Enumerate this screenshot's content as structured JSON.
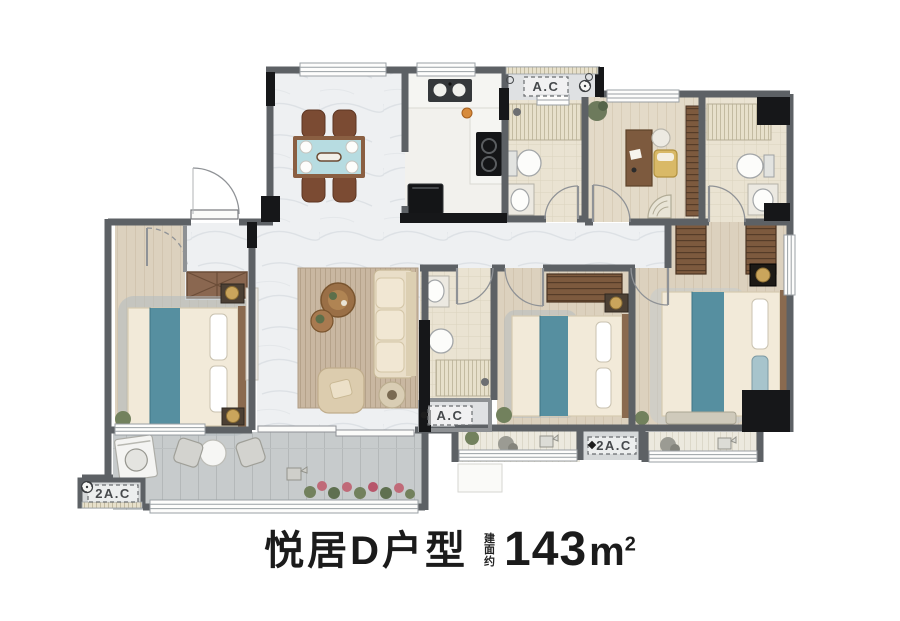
{
  "caption": {
    "name": "悦居D户型",
    "area_prefix": "建面约",
    "area_value": "143",
    "area_unit": "m",
    "area_unit_sup": "2"
  },
  "plan": {
    "ac_labels": {
      "top": "A.C",
      "middle": "A.C",
      "bottom_left": "2A.C",
      "bottom_middle": "2A.C"
    },
    "colors": {
      "wall": "#5d6165",
      "wall_dark": "#161719",
      "marble_floor": "#eef0f2",
      "wood_floor": "#dcd1be",
      "bath_floor": "#eae3d2",
      "balcony_floor": "#c7cbcc",
      "accent_teal": "#568fa0",
      "furniture_brown": "#7d5a3e",
      "sofa_cream": "#e9dec8",
      "dining_table_blue": "#b7dce1",
      "label_text": "#46494c"
    }
  }
}
